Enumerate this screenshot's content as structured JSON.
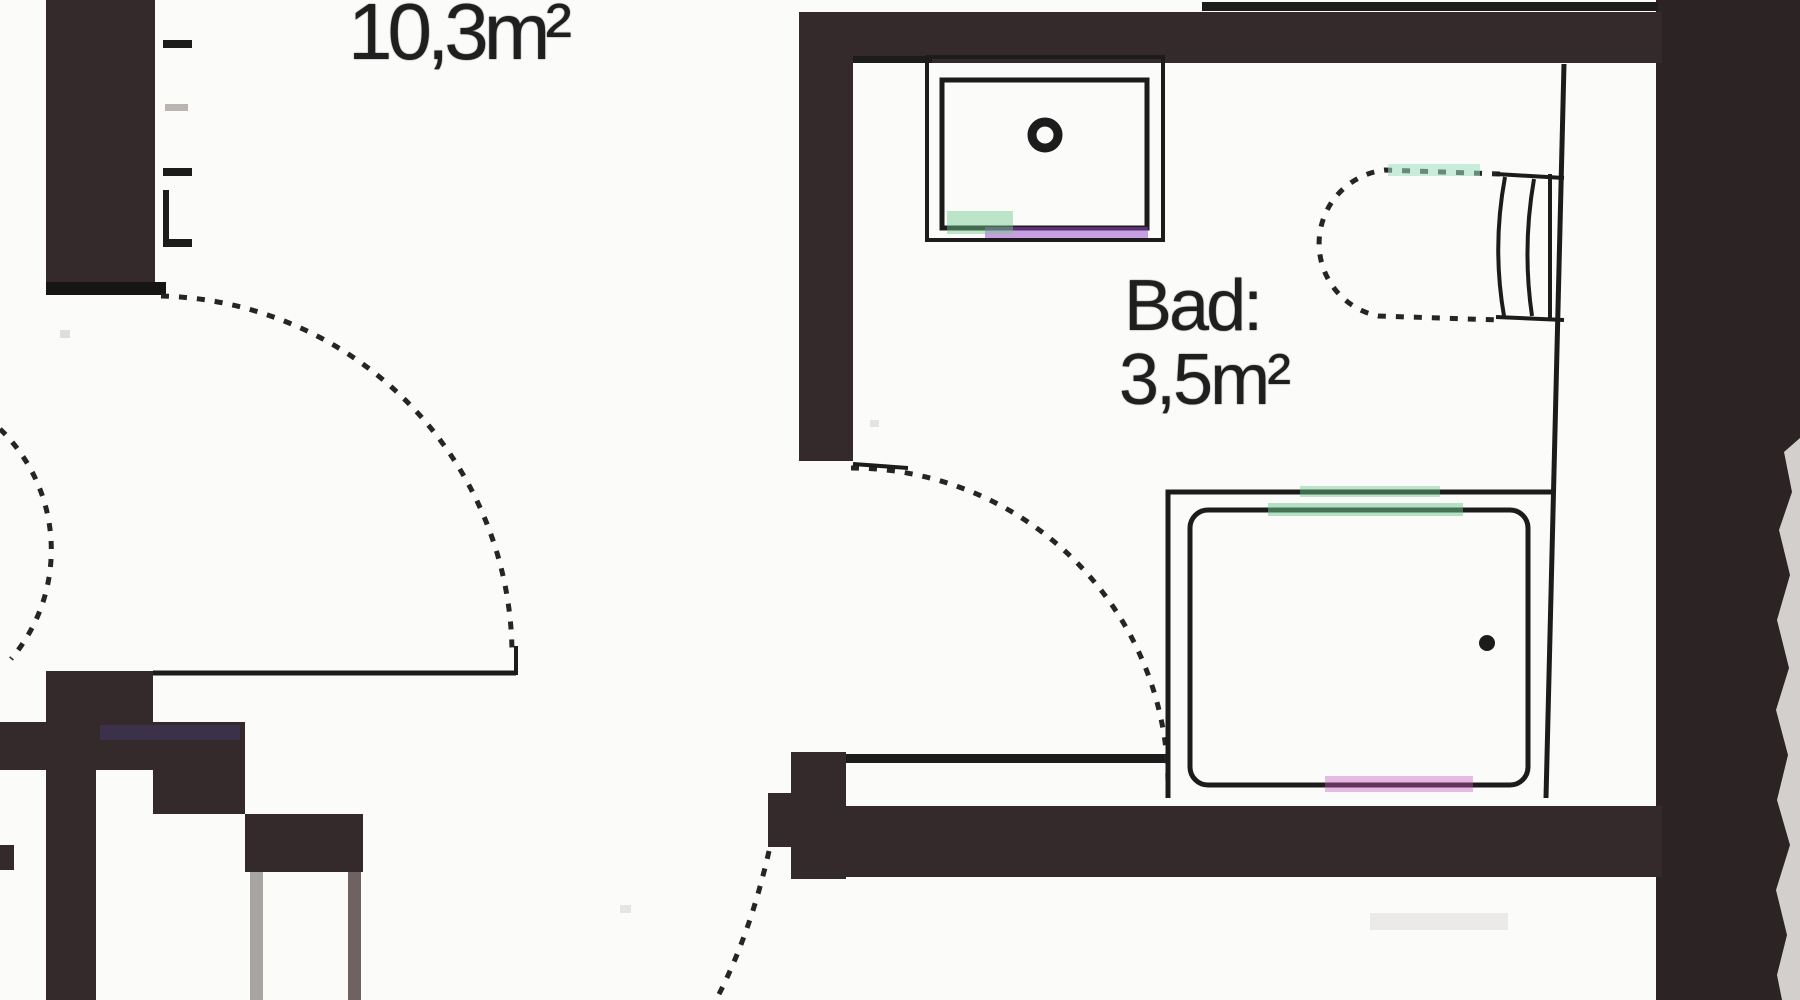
{
  "labels": {
    "room_area": "10,3m²",
    "bathroom_name": "Bad:",
    "bathroom_area": "3,5m²"
  },
  "colors": {
    "wall": "#342a2b",
    "wall_dark_cap": "#171414",
    "line": "#1c1c1c",
    "paper": "#fbfbfa",
    "scan_edge": "#2b2324",
    "paper_edge": "#d3cfcc",
    "gray_line_light": "#a8a4a1",
    "gray_line_dark": "#6e6361",
    "tick_faint": "#b9b5b2",
    "tint_green": "#6ec88c",
    "tint_purple": "#9646c8",
    "tint_blue": "#5a50c8",
    "tint_magenta": "#c85ac0"
  },
  "fixtures": {
    "sink": "washbasin",
    "toilet": "toilet-with-cistern",
    "shower": "shower-tray"
  }
}
